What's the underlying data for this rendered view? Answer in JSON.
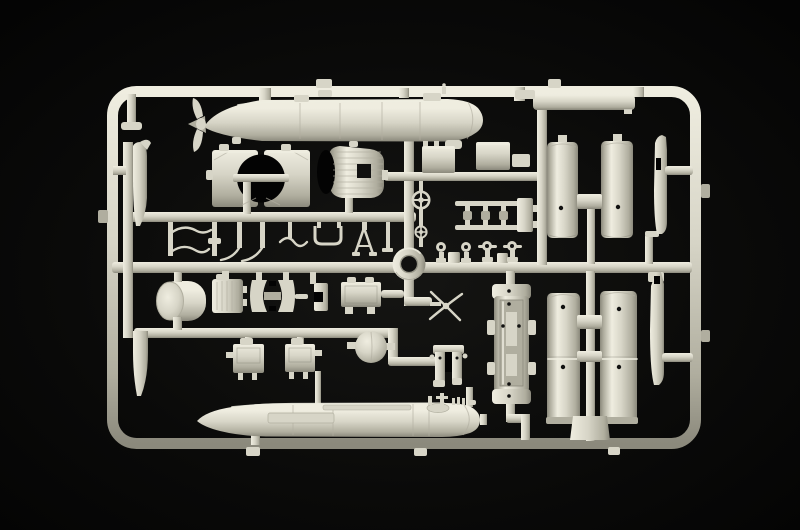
{
  "meta": {
    "subject": "injection-molded plastic model kit sprue photographed on a black background",
    "alt": "Light grey plastic model sprue with two torpedo hulls, four half-cylinder shells and many small fittings"
  },
  "colors": {
    "bg_center": "#151513",
    "bg_edge": "#030303",
    "plastic_hi": "#efede0",
    "plastic_base": "#d7d5c7",
    "plastic_lo": "#b0ae9f",
    "plastic_deep": "#8b897c",
    "hole": "#111110"
  },
  "parts": {
    "torpedo_bodies": 2,
    "half_shell_columns": 4,
    "handwheels": 2,
    "eyelet_fittings": 4,
    "mounting_rings": 1,
    "ball_floats": 1,
    "inventory": [
      "sprue frame",
      "upper torpedo with nose propeller",
      "lower torpedo hull",
      "half-cylinder shells",
      "mounting ring",
      "ball float",
      "x-propeller",
      "handwheels",
      "equipment boxes",
      "clamp plate brackets",
      "ribbed cowling",
      "wire hooks and levers",
      "eyelet fittings",
      "ladder rails",
      "cradle trough",
      "fin blades"
    ]
  }
}
